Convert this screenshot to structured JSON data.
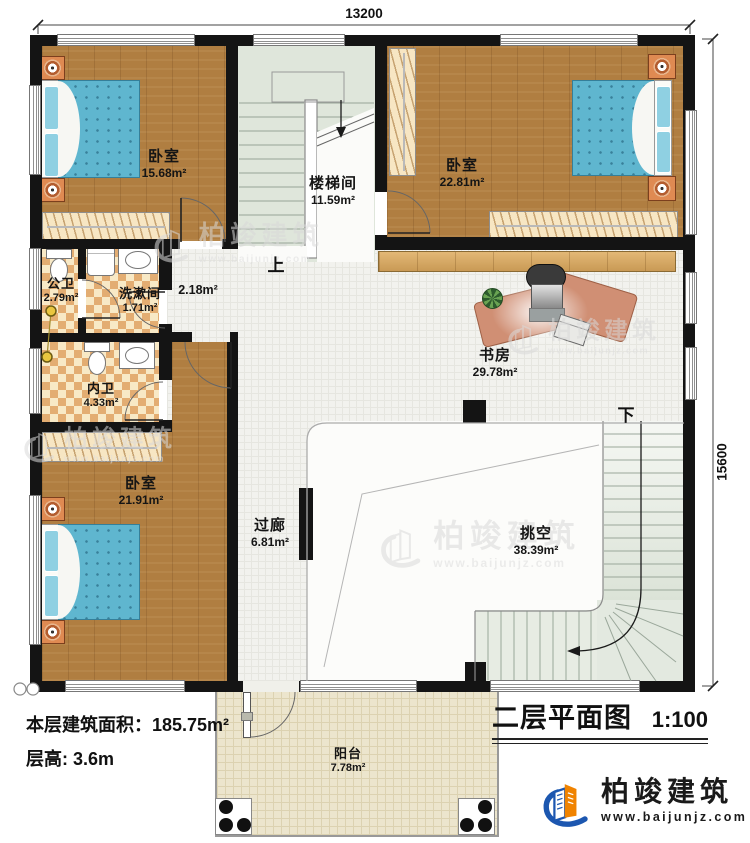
{
  "annotations": {
    "dim_width": "13200",
    "dim_height": "15600",
    "up": "上",
    "down": "下",
    "landing_area": "2.18m²"
  },
  "rooms": {
    "bedroom_tl": {
      "name": "卧室",
      "area": "15.68m²"
    },
    "stairwell": {
      "name": "楼梯间",
      "area": "11.59m²"
    },
    "bedroom_tr": {
      "name": "卧室",
      "area": "22.81m²"
    },
    "public_bath": {
      "name": "公卫",
      "area": "2.79m²"
    },
    "washroom": {
      "name": "洗漱间",
      "area": "1.71m²"
    },
    "private_bath": {
      "name": "内卫",
      "area": "4.33m²"
    },
    "bedroom_bl": {
      "name": "卧室",
      "area": "21.91m²"
    },
    "study": {
      "name": "书房",
      "area": "29.78m²"
    },
    "corridor": {
      "name": "过廊",
      "area": "6.81m²"
    },
    "void": {
      "name": "挑空",
      "area": "38.39m²"
    },
    "balcony": {
      "name": "阳台",
      "area": "7.78m²"
    }
  },
  "footer": {
    "floor_area": "本层建筑面积：185.75m²",
    "floor_height": "层高: 3.6m"
  },
  "title_block": {
    "title": "二层平面图",
    "scale": "1:100"
  },
  "brand": {
    "name": "柏竣建筑",
    "website": "www.baijunjz.com"
  },
  "watermark": {
    "name": "柏竣建筑",
    "website": "www.baijunjz.com"
  },
  "colors": {
    "wall": "#141414",
    "wood_floor": "#b07e41",
    "stair_floor": "#dfe6db",
    "bath_tile_a": "#e3ad72",
    "bath_tile_b": "#f8e9c6",
    "bed": "#5fb6cf",
    "desk": "#d08f74",
    "brand_blue": "#1c57b0",
    "brand_orange": "#f08300"
  }
}
